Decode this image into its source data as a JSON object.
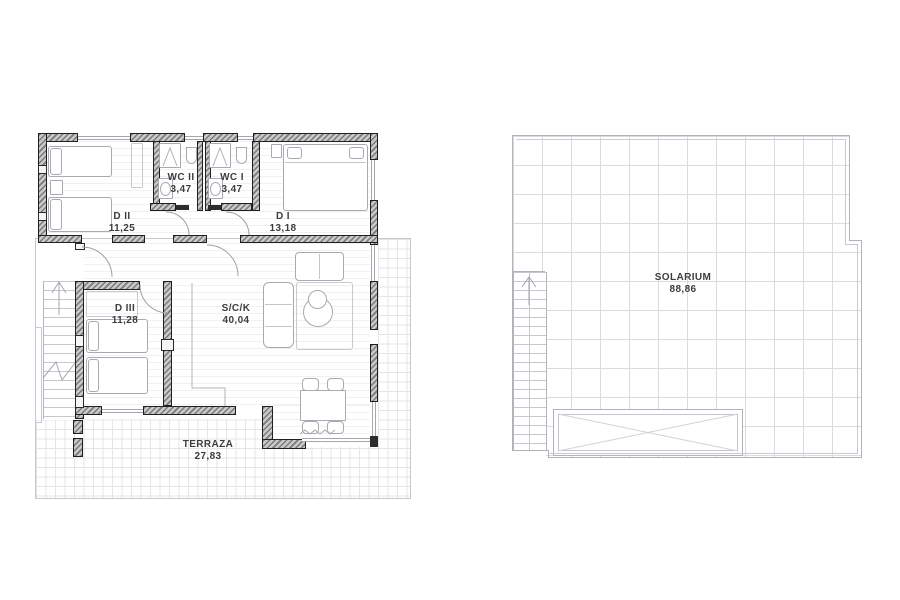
{
  "plans": {
    "ground": {
      "rooms": [
        {
          "key": "d2",
          "label": "D II",
          "area": "11,25"
        },
        {
          "key": "wc2",
          "label": "WC II",
          "area": "3,47"
        },
        {
          "key": "wc1",
          "label": "WC I",
          "area": "3,47"
        },
        {
          "key": "d1",
          "label": "D I",
          "area": "13,18"
        },
        {
          "key": "d3",
          "label": "D III",
          "area": "11,28"
        },
        {
          "key": "sck",
          "label": "S/C/K",
          "area": "40,04"
        },
        {
          "key": "terraza",
          "label": "TERRAZA",
          "area": "27,83"
        }
      ]
    },
    "roof": {
      "rooms": [
        {
          "key": "solarium",
          "label": "SOLARIUM",
          "area": "88,86"
        }
      ]
    }
  },
  "icons": {
    "stairs_ground": "up-arrow",
    "stairs_roof": "up-arrow"
  },
  "colors": {
    "wall_hatch": "#7a7a7a",
    "wall_edge": "#1f1f1f",
    "label_text": "#3d3d3d",
    "terrace_grid": "#e4e4e9",
    "solarium_grid": "#dadae0",
    "outline": "#b2b2ba",
    "thin_line": "#a6a6ae",
    "background": "#ffffff"
  }
}
